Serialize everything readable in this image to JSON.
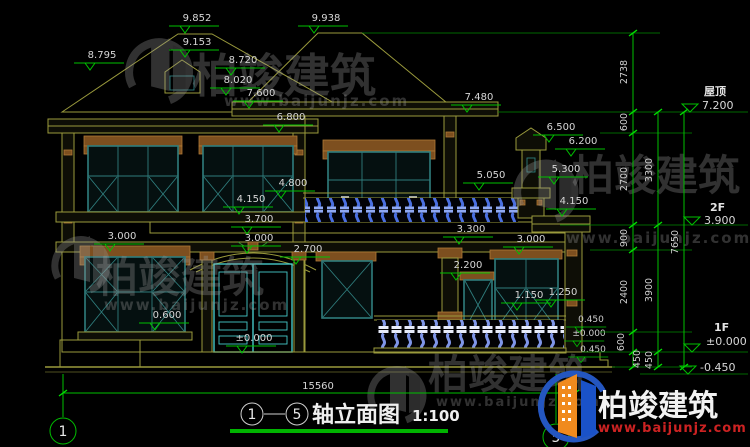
{
  "title": {
    "left_axis": "1",
    "right_axis": "5",
    "dash": "-",
    "name": "轴立面图",
    "scale": "1:100"
  },
  "axis_bubbles": {
    "left": "1",
    "right": "5"
  },
  "total_width_dim": "15560",
  "right_levels": [
    {
      "label": "屋顶",
      "value": "7.200"
    },
    {
      "label": "2F",
      "value": "3.900"
    },
    {
      "label": "1F",
      "value": "±0.000"
    },
    {
      "label": "",
      "value": "-0.450"
    }
  ],
  "right_chains": {
    "top": "2738",
    "inner": [
      "600",
      "2700",
      "900",
      "2400",
      "600",
      "450"
    ],
    "middle": [
      "3300",
      "3900",
      "450"
    ],
    "outer": "7650"
  },
  "elevation_marks": [
    "9.852",
    "9.938",
    "9.153",
    "8.720",
    "8.020",
    "8.795",
    "7.600",
    "7.480",
    "6.800",
    "6.500",
    "6.200",
    "5.300",
    "5.050",
    "4.800",
    "4.150",
    "4.150",
    "3.700",
    "3.000",
    "3.000",
    "2.700",
    "3.300",
    "3.000",
    "2.200",
    "1.150",
    "1.250",
    "0.600",
    "±0.000",
    "0.450",
    "±0.000",
    "0.450"
  ],
  "watermark": {
    "brand": "柏竣建筑",
    "url": "www.baijunjz.com"
  },
  "logo": {
    "brand": "柏竣建筑",
    "url": "www.baijunjz.com"
  },
  "colors": {
    "dimension_green": "#00c000",
    "outline_olive": "#9a9a3c",
    "window_teal": "#2f7d7d",
    "door_cyan": "#45c8c8",
    "baluster_blue": "#4a6fe0",
    "accent_brown": "#8a5a26",
    "logo_red": "#cc2222",
    "logo_blue": "#1a52c8",
    "logo_orange": "#f08a1e"
  }
}
